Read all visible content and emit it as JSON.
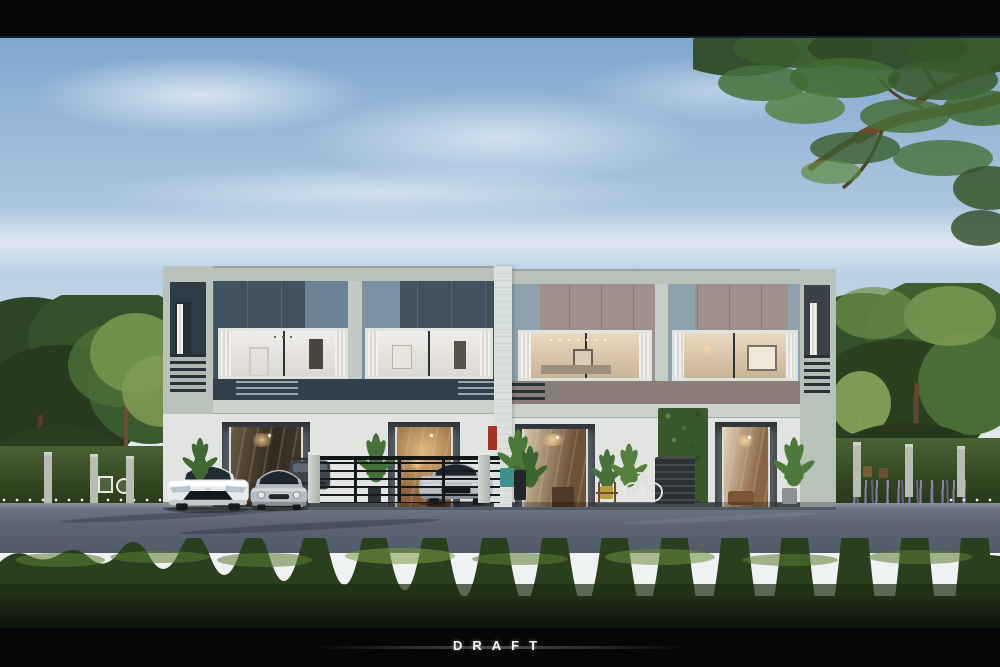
{
  "watermark": {
    "label": "DRAFT"
  },
  "scene": {
    "type": "3d-architectural-exterior-rendering",
    "subject": "modern two-story townhouse row of four units, street view",
    "objects": [
      "sky",
      "clouds",
      "overhanging-tree-branch",
      "side-trees",
      "townhouse-building",
      "balcony-railings",
      "upper-floor-glass-panels",
      "upper-floor-windows-with-interiors",
      "ground-floor-glass-doors",
      "vertical-garden-green-wall",
      "potted-plants",
      "bicycle",
      "white-sedan",
      "silver-mini-hatchback",
      "dark-gray-car",
      "silver-sedan",
      "black-metal-fence",
      "garden-hedge-and-posts",
      "garden-furniture",
      "lavender-flowers",
      "white-flowers",
      "asphalt-road",
      "foreground-hedge",
      "dark-lawn",
      "letterbox-bars"
    ],
    "colors": {
      "letterbox": "#050605",
      "watermark_text": "#f2f2f2",
      "sky_top": "#7fa6d0",
      "sky_mid": "#b7cde2",
      "sky_horizon": "#eef1f3",
      "facade_frame": "#b9c1bb",
      "facade_white": "#e2e4e1",
      "panel_slate": "#41525e",
      "panel_slate_light": "#6d8294",
      "panel_taupe": "#9e908b",
      "panel_taupe_accent": "#8ea1ac",
      "window_cool": "#e9e7e3",
      "window_warm": "#e6d8bd",
      "interior_warm_glow": "#d8ae76",
      "accent_dark_wall": "#565d63",
      "green_wall": "#39582b",
      "fence_black": "#181b1e",
      "road_asphalt": "#5a6571",
      "hedge_green": "#2a3f1d",
      "hedge_highlight": "#5c7d36",
      "lawn_dark": "#141d0f",
      "tree_dark": "#2e4527",
      "tree_light": "#6f8f4a",
      "branch_wood": "#6b4b2e",
      "car_white": "#e9ebed",
      "car_silver": "#b6bcc3",
      "car_dark": "#3f444a",
      "lavender": "#9b8cc4"
    }
  }
}
